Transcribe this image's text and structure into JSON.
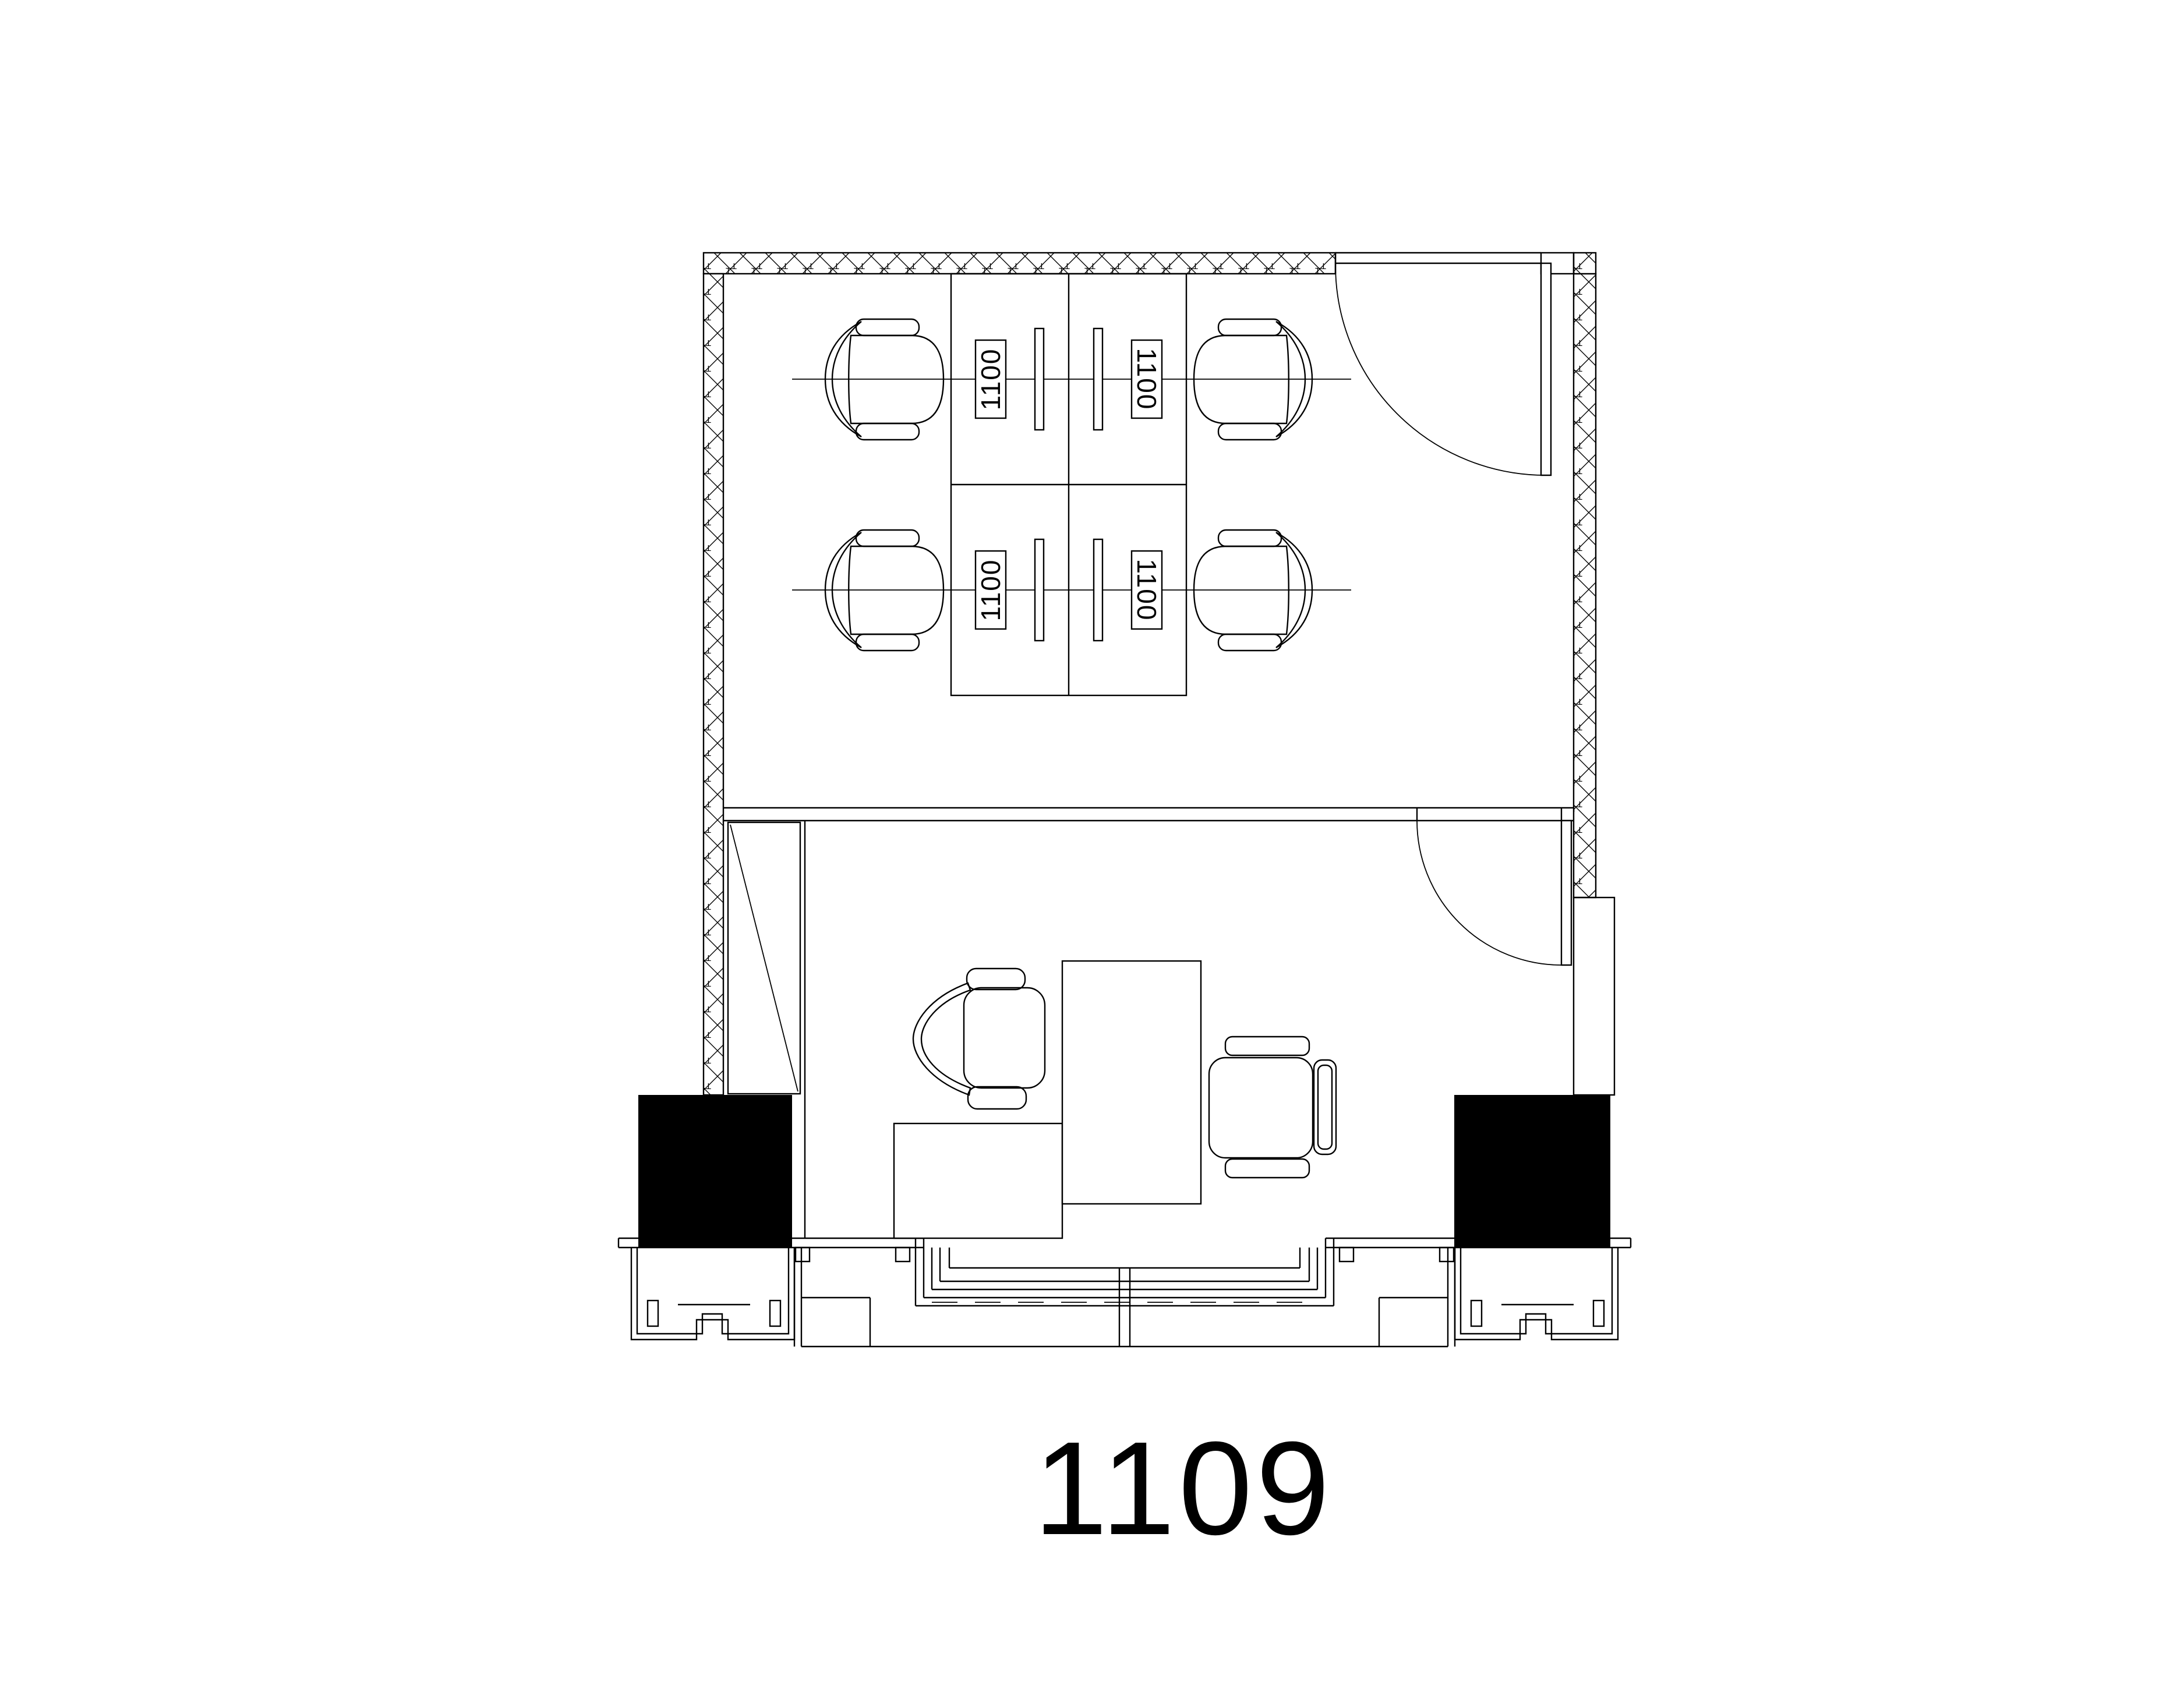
{
  "drawing": {
    "plan_number": "1109",
    "workstation_labels": [
      "1100",
      "1100",
      "1100",
      "1100"
    ],
    "colors": {
      "line": "#000000",
      "background": "#ffffff",
      "column_fill": "#000000"
    }
  }
}
